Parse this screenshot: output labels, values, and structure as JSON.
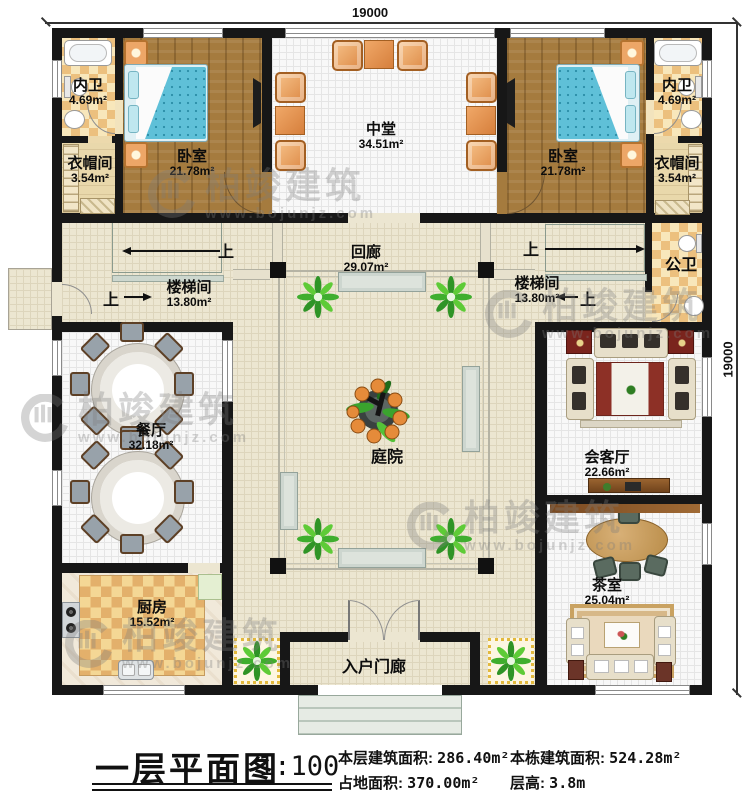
{
  "dimensions": {
    "top": "19000",
    "right": "19000"
  },
  "watermark": {
    "brand": "柏竣建筑",
    "url": "www.bojunjz.com"
  },
  "nav": {
    "up": "上"
  },
  "rooms": {
    "bath_left": {
      "name": "内卫",
      "area": "4.69m²"
    },
    "cloak_left": {
      "name": "衣帽间",
      "area": "3.54m²"
    },
    "bedroom_left": {
      "name": "卧室",
      "area": "21.78m²"
    },
    "hall": {
      "name": "中堂",
      "area": "34.51m²"
    },
    "bedroom_right": {
      "name": "卧室",
      "area": "21.78m²"
    },
    "bath_right": {
      "name": "内卫",
      "area": "4.69m²"
    },
    "cloak_right": {
      "name": "衣帽间",
      "area": "3.54m²"
    },
    "corridor": {
      "name": "回廊",
      "area": "29.07m²"
    },
    "stair_left": {
      "name": "楼梯间",
      "area": "13.80m²"
    },
    "stair_right": {
      "name": "楼梯间",
      "area": "13.80m²"
    },
    "public_bath": {
      "name": "公卫",
      "area": ""
    },
    "dining": {
      "name": "餐厅",
      "area": "32.18m²"
    },
    "courtyard": {
      "name": "庭院",
      "area": ""
    },
    "reception": {
      "name": "会客厅",
      "area": "22.66m²"
    },
    "tea_room": {
      "name": "茶室",
      "area": "25.04m²"
    },
    "kitchen": {
      "name": "厨房",
      "area": "15.52m²"
    },
    "entry_porch": {
      "name": "入户门廊",
      "area": ""
    }
  },
  "titleblock": {
    "title": "一层平面图",
    "scale": "1:100",
    "stats": [
      {
        "label": "本层建筑面积:",
        "value": "286.40m²"
      },
      {
        "label": "占地面积:",
        "value": "370.00m²"
      },
      {
        "label": "本栋建筑面积:",
        "value": "524.28m²"
      },
      {
        "label": "层高:",
        "value": "3.8m"
      }
    ]
  }
}
